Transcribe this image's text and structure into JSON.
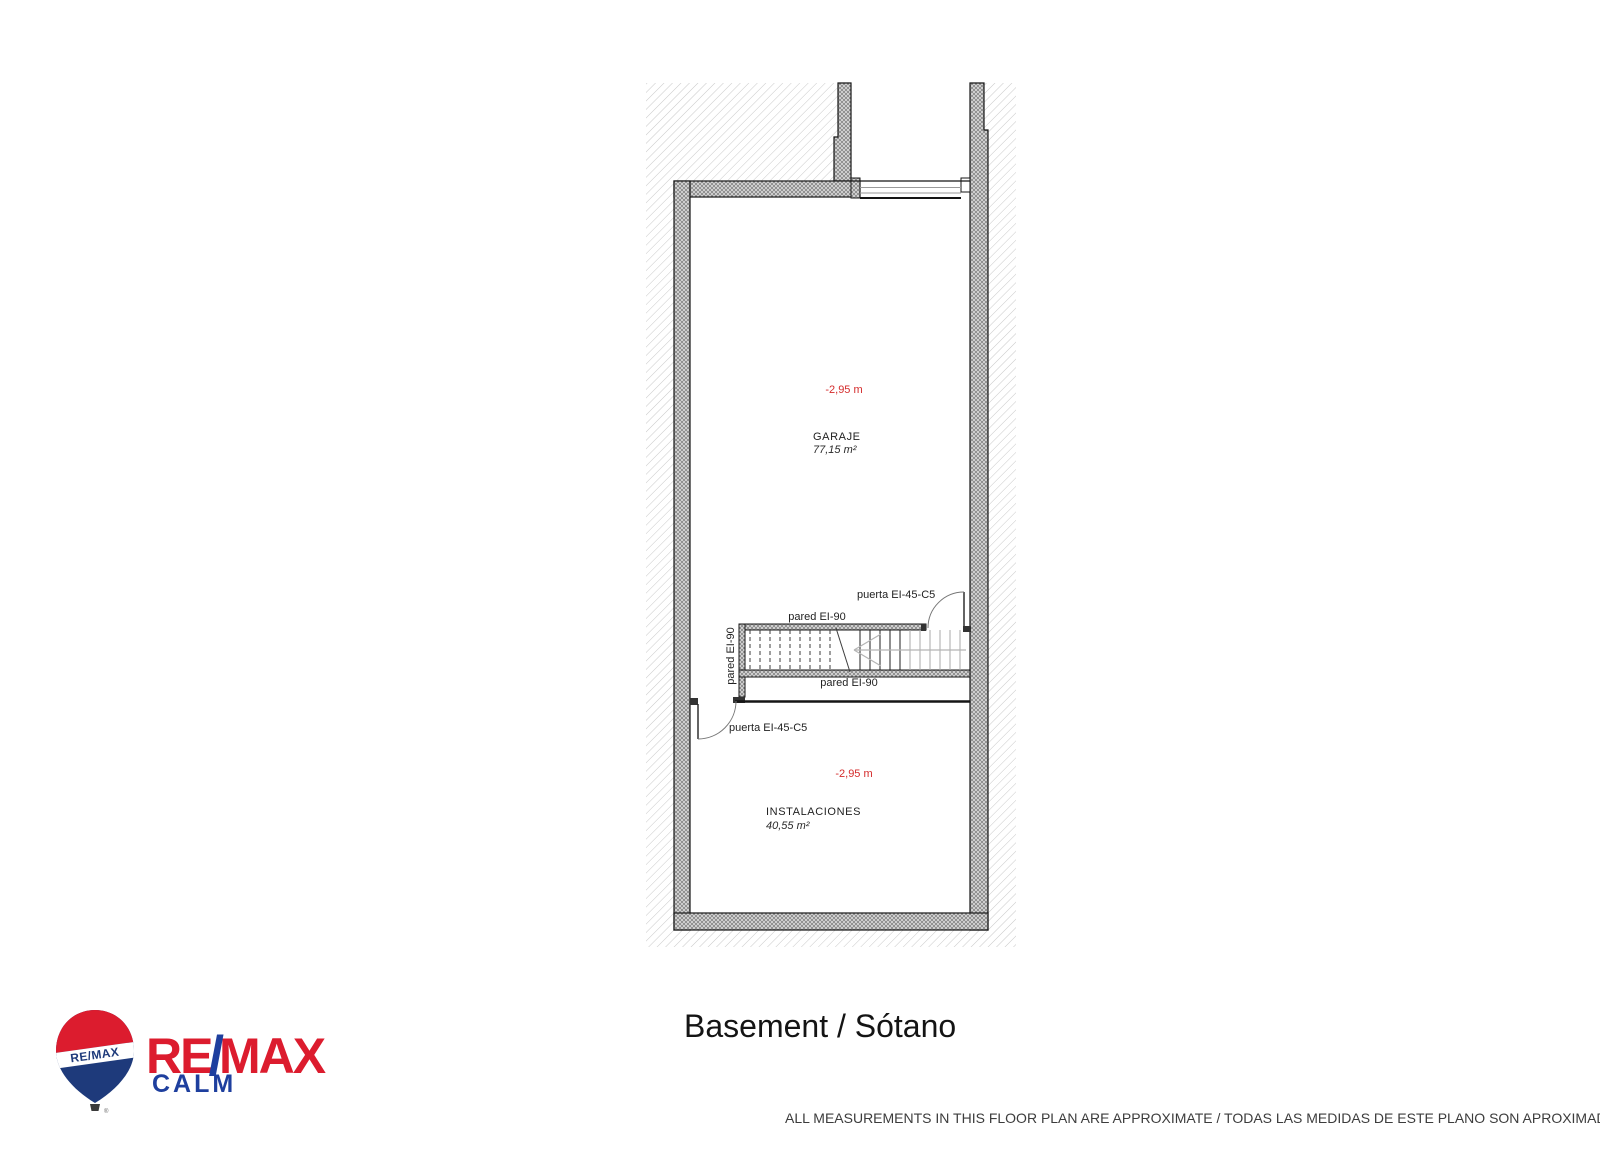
{
  "colors": {
    "label_red": "#d42b2b",
    "remax_red": "#dc1c2e",
    "remax_blue": "#1e3f9e",
    "balloon_blue": "#1e3a7b"
  },
  "plan": {
    "rooms": [
      {
        "id": "garaje",
        "level": "-2,95 m",
        "name": "GARAJE",
        "area": "77,15 m²"
      },
      {
        "id": "instalaciones",
        "level": "-2,95 m",
        "name": "INSTALACIONES",
        "area": "40,55 m²"
      }
    ],
    "walls": {
      "top_label": "pared EI-90",
      "left_label": "pared EI-90",
      "bottom_label": "pared EI-90"
    },
    "doors": {
      "upper_label": "puerta EI-45-C5",
      "lower_label": "puerta EI-45-C5"
    }
  },
  "footer": {
    "title": "Basement / Sótano",
    "disclaimer": "ALL MEASUREMENTS IN THIS FLOOR PLAN ARE APPROXIMATE / TODAS LAS MEDIDAS DE ESTE PLANO SON APROXIMADAS"
  },
  "logo": {
    "balloon_text": "RE/MAX",
    "brand_re": "RE",
    "brand_slash": "/",
    "brand_max": "MAX",
    "office": "CALM",
    "registered": "®"
  }
}
